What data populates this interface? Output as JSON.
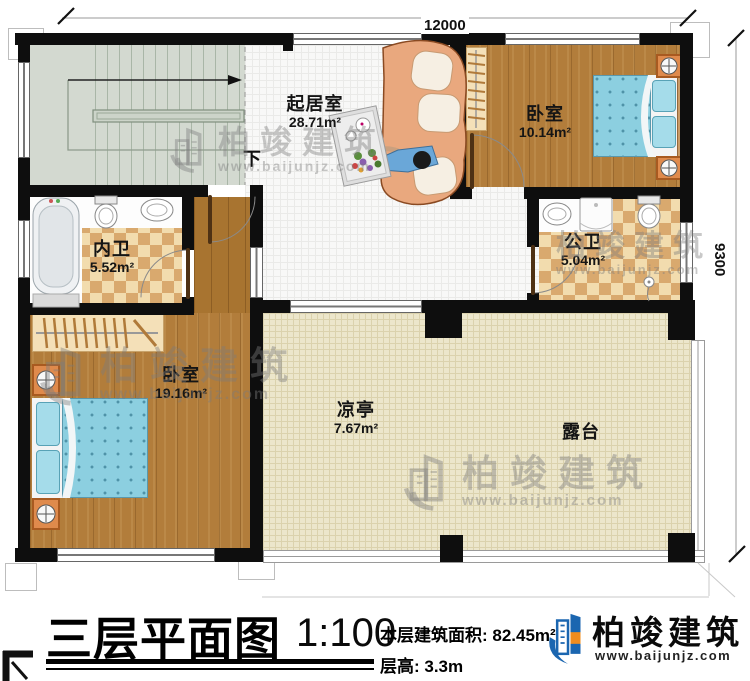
{
  "plan": {
    "dimensions": {
      "top": "12000",
      "right": "9300"
    },
    "stairs": {
      "down": "下"
    },
    "rooms": {
      "living": {
        "name": "起居室",
        "area": "28.71m²"
      },
      "bedroom_top": {
        "name": "卧室",
        "area": "10.14m²"
      },
      "bath_inner": {
        "name": "内卫",
        "area": "5.52m²"
      },
      "bath_public": {
        "name": "公卫",
        "area": "5.04m²"
      },
      "bedroom_left": {
        "name": "卧室",
        "area": "19.16m²"
      },
      "pavilion": {
        "name": "凉亭",
        "area": "7.67m²"
      },
      "terrace": {
        "name": "露台"
      }
    },
    "watermark": {
      "name": "柏竣建筑",
      "url": "www.baijunjz.com"
    }
  },
  "footer": {
    "title": "三层平面图",
    "scale": "1:100",
    "area_line": "本层建筑面积: 82.45m²",
    "height_line": "层高: 3.3m",
    "brand_name": "柏竣建筑",
    "brand_url": "www.baijunjz.com"
  },
  "colors": {
    "wall": "#0e0e0e",
    "wood": "#b27d3b",
    "terrace": "#ece6cb",
    "bed": "#8ccfe0",
    "brand_blue": "#1b66b0",
    "brand_orange": "#f08c1e"
  }
}
